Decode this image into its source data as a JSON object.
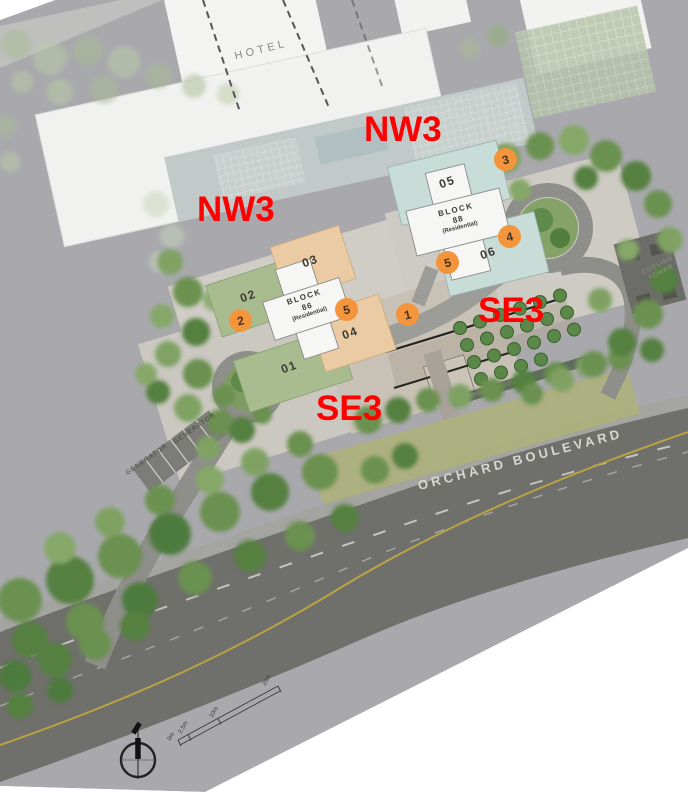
{
  "site_plan": {
    "hotel_label": "HOTEL",
    "road_label": "ORCHARD BOULEVARD",
    "cooling_tower_lines": [
      "COOLING",
      "TOWER"
    ],
    "generator_labels": [
      "GENERATOR",
      "GENERATOR"
    ],
    "facing_labels": [
      {
        "id": "nw3-left",
        "text": "NW3"
      },
      {
        "id": "nw3-right",
        "text": "NW3"
      },
      {
        "id": "se3-left",
        "text": "SE3"
      },
      {
        "id": "se3-right",
        "text": "SE3"
      }
    ],
    "blocks": [
      {
        "lines": [
          "BLOCK",
          "86",
          "(Residential)"
        ]
      },
      {
        "lines": [
          "BLOCK",
          "88",
          "(Residential)"
        ]
      }
    ],
    "unit_labels": [
      "01",
      "02",
      "03",
      "04",
      "05",
      "06"
    ],
    "markers": [
      "1",
      "2",
      "3",
      "4",
      "5",
      "5"
    ],
    "scale_ticks": [
      "0m",
      "2.5m",
      "10m",
      "25m"
    ],
    "colors": {
      "annotation_red": "#FF0000",
      "marker_orange": "#F2953C",
      "unit_block_green": "#A9BC8F",
      "unit_block_tan": "#EACBA4",
      "unit_block_blue": "#C8DCD8",
      "residential_block_white": "#F6F6F4",
      "photo_background": "#A9A9AD"
    }
  }
}
